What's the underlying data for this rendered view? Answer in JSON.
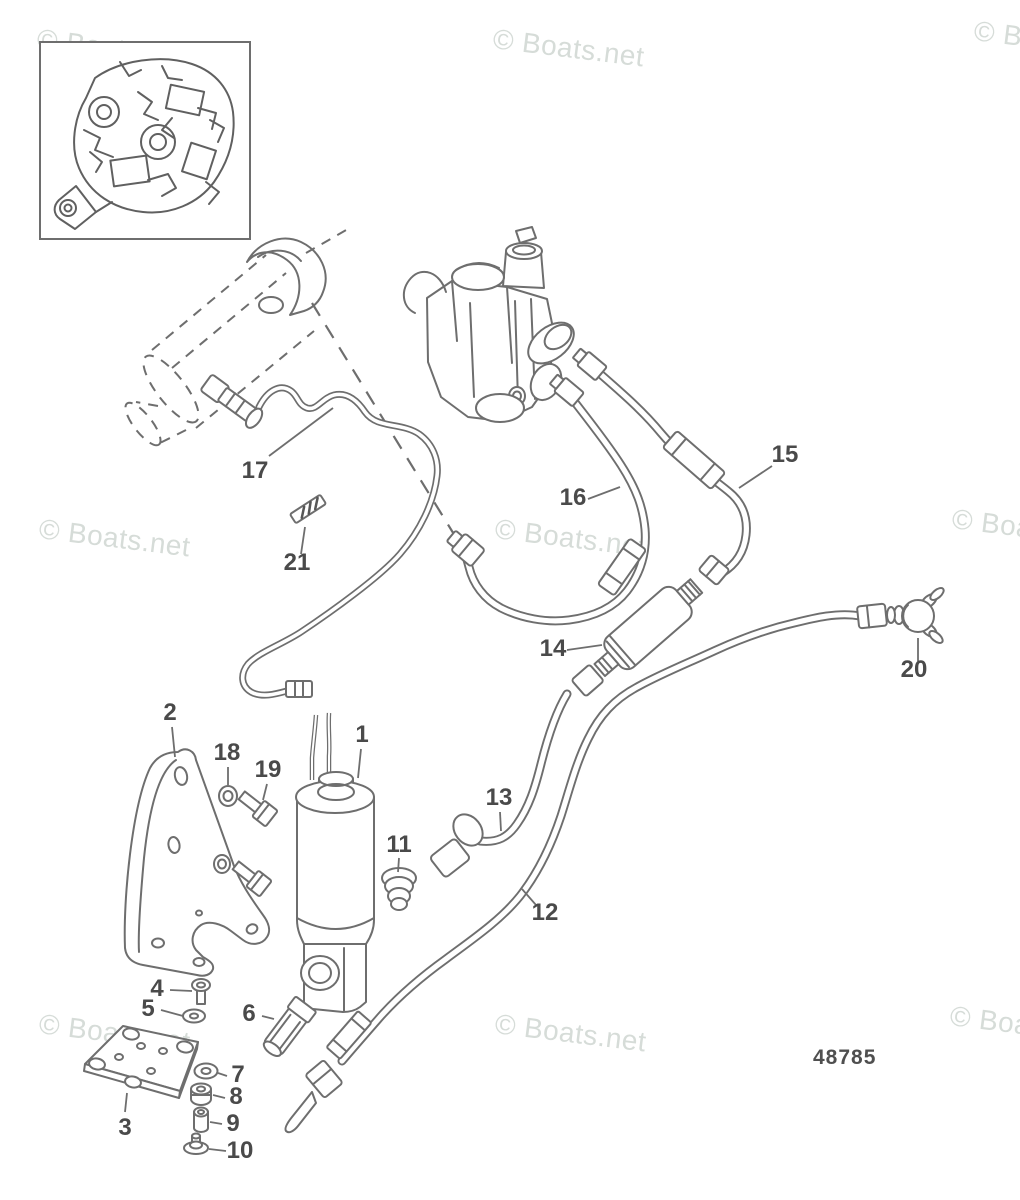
{
  "watermark": {
    "text": "© Boats.net",
    "color": "#d6dcd8"
  },
  "drawing_number": "48785",
  "callout_labels": [
    "1",
    "2",
    "3",
    "4",
    "5",
    "6",
    "7",
    "8",
    "9",
    "10",
    "11",
    "12",
    "13",
    "14",
    "15",
    "16",
    "17",
    "18",
    "19",
    "20",
    "21"
  ],
  "colors": {
    "line": "#6e6e6e",
    "label_text": "#4a4a4a",
    "watermark": "#d6dcd8",
    "background": "#ffffff"
  }
}
